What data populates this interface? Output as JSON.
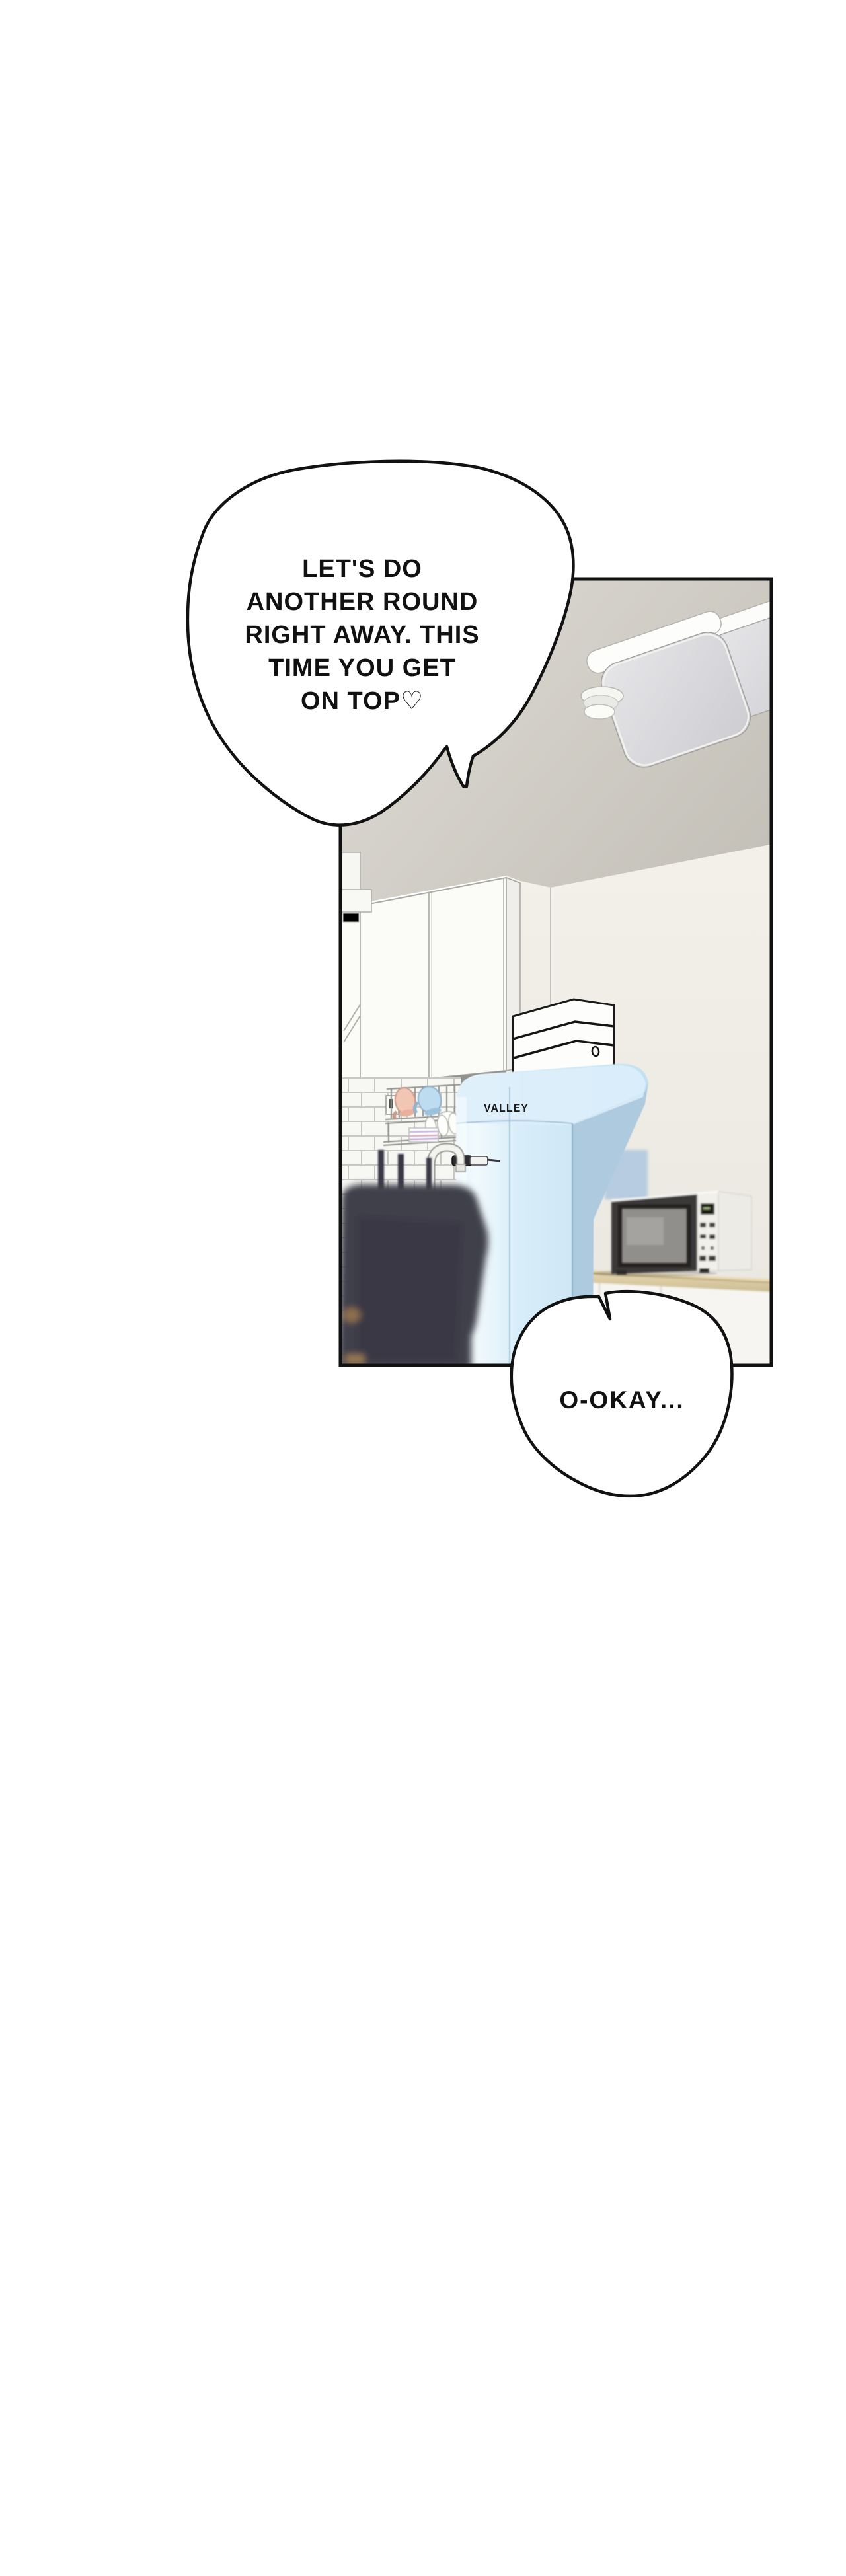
{
  "bubbles": {
    "top": {
      "lines": [
        "LET'S DO",
        "ANOTHER ROUND",
        "RIGHT AWAY. THIS",
        "TIME YOU GET",
        "ON TOP♡"
      ]
    },
    "bottom": {
      "text": "O-OKAY..."
    }
  },
  "scene": {
    "fridge_brand": "VALLEY",
    "objects": [
      "ceiling-lights",
      "smoke-detector",
      "upper-cabinets",
      "range-hood",
      "tile-backsplash",
      "dish-rack",
      "mugs",
      "faucet",
      "retro-fridge",
      "storage-boxes",
      "microwave",
      "wood-counter",
      "lower-cabinet",
      "blurred-foreground-object"
    ]
  },
  "palette": {
    "page_background": "#ffffff",
    "panel_border": "#111111",
    "ceiling": "#d4d1c9",
    "wall_cream": "#efede5",
    "fridge_blue": "#cfe7f5",
    "fridge_side_blue": "#aecadf",
    "counter_wood": "#d8c79f",
    "microwave_front": "#3b3937",
    "foreground_dark": "#403e4a",
    "mug_pink": "#f2c6b4",
    "mug_blue": "#bedcf0"
  }
}
